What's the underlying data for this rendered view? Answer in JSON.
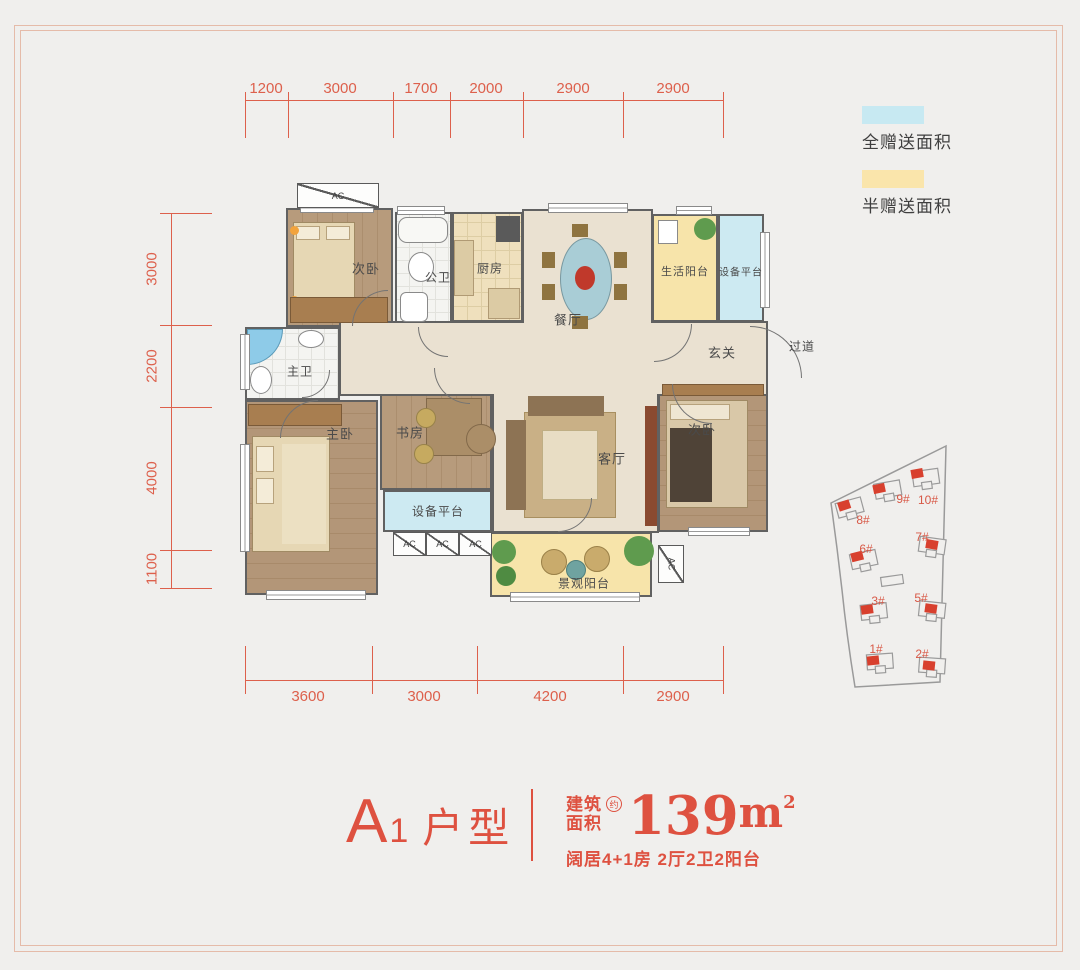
{
  "colors": {
    "dimension_red": "#dd604c",
    "title_red": "#de5140",
    "full_gift_blue": "#c7e9f2",
    "half_gift_yellow": "#fae5ab",
    "site_marker_red": "#d8402e"
  },
  "legend": {
    "full_gift": {
      "label": "全赠送面积",
      "color": "#c7e9f2"
    },
    "half_gift": {
      "label": "半赠送面积",
      "color": "#fae5ab"
    }
  },
  "dimensions": {
    "top": [
      "1200",
      "3000",
      "1700",
      "2000",
      "2900",
      "2900"
    ],
    "left": [
      "3000",
      "2200",
      "4000",
      "1100"
    ],
    "bottom": [
      "3600",
      "3000",
      "4200",
      "2900"
    ]
  },
  "rooms": {
    "bedroom2_top": "次卧",
    "public_bath": "公卫",
    "kitchen": "厨房",
    "dining": "餐厅",
    "life_balcony": "生活阳台",
    "equip_platform_top": "设备平台",
    "master_bath": "主卫",
    "hallway": "玄关",
    "corridor": "过道",
    "master_bedroom": "主卧",
    "study": "书房",
    "equip_platform_bottom": "设备平台",
    "living": "客厅",
    "bedroom2_right": "次卧",
    "view_balcony": "景观阳台",
    "ac": "AC"
  },
  "site_plan": {
    "buildings": [
      "1#",
      "2#",
      "3#",
      "5#",
      "6#",
      "7#",
      "8#",
      "9#",
      "10#"
    ]
  },
  "title": {
    "name_main": "A",
    "name_sub": "1",
    "name_rest": "户型",
    "area_label_line1": "建筑",
    "area_label_line2": "面积",
    "area_approx": "约",
    "area_value": "139",
    "area_unit": "m",
    "area_exp": "2",
    "description": "阔居4+1房 2厅2卫2阳台"
  }
}
